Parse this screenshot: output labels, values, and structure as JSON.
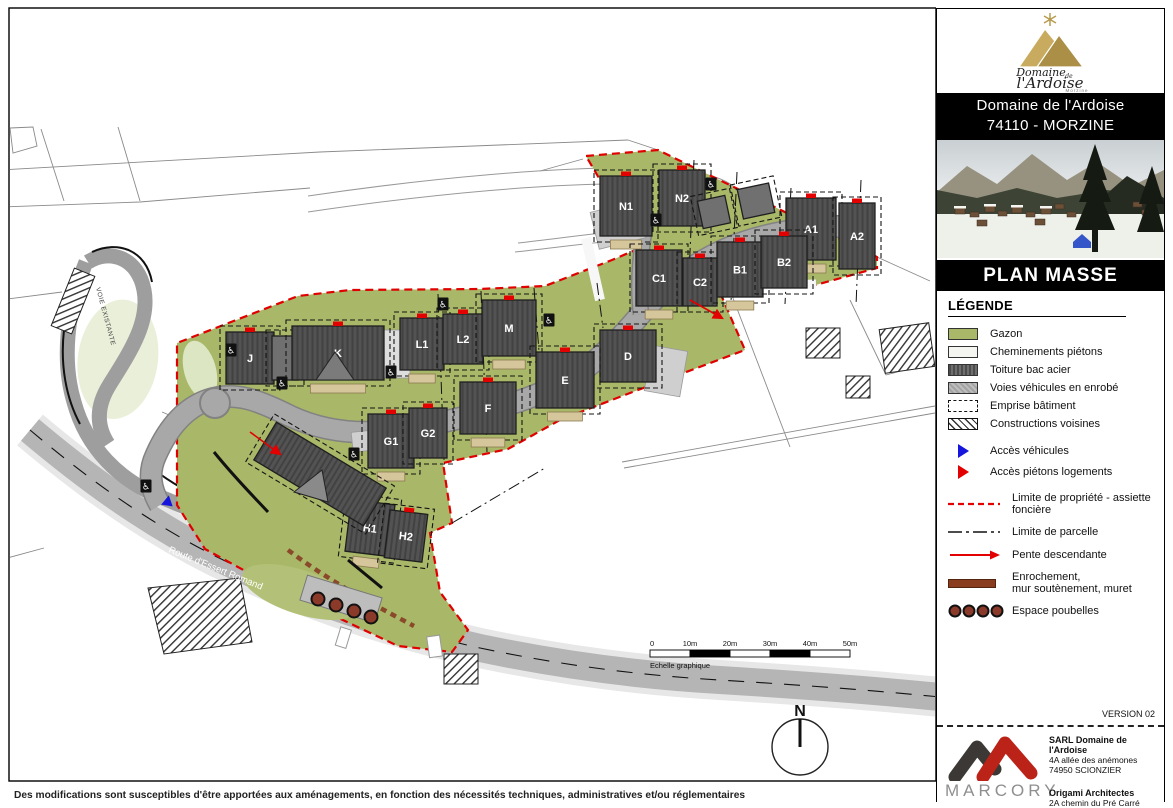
{
  "sidebar": {
    "logo": {
      "name": "Domaine",
      "de": "de",
      "name2": "l'Ardoise",
      "sub": "Morzine"
    },
    "address_banner": {
      "line1": "Domaine de l'Ardoise",
      "line2": "74110 - MORZINE"
    },
    "plan_title": "PLAN MASSE",
    "legend": {
      "title": "LÉGENDE",
      "items": [
        {
          "swatch": "gazon",
          "label": "Gazon"
        },
        {
          "swatch": "chemin",
          "label": "Cheminements piétons"
        },
        {
          "swatch": "toiture",
          "label": "Toiture bac acier"
        },
        {
          "swatch": "enrobe",
          "label": "Voies véhicules en enrobé"
        },
        {
          "swatch": "emprise",
          "label": "Emprise bâtiment"
        },
        {
          "swatch": "voisines",
          "label": "Constructions voisines"
        }
      ],
      "access_items": [
        {
          "swatch": "tri-blue",
          "label": "Accès véhicules"
        },
        {
          "swatch": "tri-red",
          "label": "Accès piétons logements"
        }
      ],
      "line_items": [
        {
          "swatch": "red-dash",
          "label": "Limite de propriété - assiette foncière"
        },
        {
          "swatch": "dash-dot",
          "label": "Limite de parcelle"
        },
        {
          "swatch": "arrow-red",
          "label": "Pente descendante"
        },
        {
          "swatch": "brown-bar",
          "label": "Enrochement,\nmur soutènement, muret"
        },
        {
          "swatch": "bins",
          "label": "Espace poubelles"
        }
      ]
    },
    "version": "VERSION 02",
    "footer": {
      "marcory": "MARCORY",
      "client_name": "SARL Domaine de l'Ardoise",
      "client_addr1": "4A allée des anémones",
      "client_addr2": "74950 SCIONZIER",
      "architect_name": "Origami Architectes",
      "architect_addr": "2A chemin du Pré Carré"
    }
  },
  "map": {
    "colors": {
      "site_green": "#a9b768",
      "road_gray": "#a8a8a8",
      "building": "#4f4f4f",
      "boundary_red": "#e00000"
    },
    "buildings": [
      {
        "label": "N1",
        "x": 600,
        "y": 176,
        "w": 52,
        "h": 60,
        "r": 0,
        "t": 1
      },
      {
        "label": "N2",
        "x": 659,
        "y": 170,
        "w": 46,
        "h": 56,
        "r": 0,
        "t": 0
      },
      {
        "label": "",
        "x": 700,
        "y": 198,
        "w": 28,
        "h": 28,
        "r": -12,
        "t": 0,
        "s": 1
      },
      {
        "label": "",
        "x": 740,
        "y": 186,
        "w": 32,
        "h": 30,
        "r": -12,
        "t": 0,
        "s": 1
      },
      {
        "label": "A1",
        "x": 786,
        "y": 198,
        "w": 50,
        "h": 62,
        "r": 0,
        "t": 1
      },
      {
        "label": "A2",
        "x": 839,
        "y": 203,
        "w": 36,
        "h": 66,
        "r": 0,
        "t": 0
      },
      {
        "label": "C1",
        "x": 636,
        "y": 250,
        "w": 46,
        "h": 56,
        "r": 0,
        "t": 1
      },
      {
        "label": "C2",
        "x": 683,
        "y": 258,
        "w": 34,
        "h": 48,
        "r": 0,
        "t": 0
      },
      {
        "label": "B1",
        "x": 717,
        "y": 242,
        "w": 46,
        "h": 55,
        "r": 0,
        "t": 1
      },
      {
        "label": "B2",
        "x": 761,
        "y": 236,
        "w": 46,
        "h": 52,
        "r": 0,
        "t": 0
      },
      {
        "label": "L1",
        "x": 400,
        "y": 318,
        "w": 44,
        "h": 52,
        "r": 0,
        "t": 1
      },
      {
        "label": "L2",
        "x": 443,
        "y": 314,
        "w": 40,
        "h": 50,
        "r": 0,
        "t": 0
      },
      {
        "label": "M",
        "x": 482,
        "y": 300,
        "w": 54,
        "h": 56,
        "r": 0,
        "t": 1
      },
      {
        "label": "D",
        "x": 600,
        "y": 330,
        "w": 56,
        "h": 52,
        "r": 0,
        "t": 0
      },
      {
        "label": "E",
        "x": 536,
        "y": 352,
        "w": 58,
        "h": 56,
        "r": 0,
        "t": 1
      },
      {
        "label": "F",
        "x": 460,
        "y": 382,
        "w": 56,
        "h": 52,
        "r": 0,
        "t": 1
      },
      {
        "label": "G1",
        "x": 368,
        "y": 414,
        "w": 46,
        "h": 54,
        "r": 0,
        "t": 1
      },
      {
        "label": "G2",
        "x": 409,
        "y": 408,
        "w": 38,
        "h": 50,
        "r": 0,
        "t": 0
      },
      {
        "label": "H1",
        "x": 348,
        "y": 502,
        "w": 44,
        "h": 52,
        "r": 7,
        "t": 1
      },
      {
        "label": "H2",
        "x": 387,
        "y": 512,
        "w": 38,
        "h": 48,
        "r": 7,
        "t": 0
      },
      {
        "label": "J",
        "x": 226,
        "y": 332,
        "w": 48,
        "h": 52,
        "r": 0,
        "t": 0
      },
      {
        "label": "",
        "x": 272,
        "y": 336,
        "w": 26,
        "h": 44,
        "r": 0,
        "t": 0,
        "s": 1
      },
      {
        "label": "K",
        "x": 292,
        "y": 326,
        "w": 92,
        "h": 54,
        "r": 0,
        "t": 1
      },
      {
        "label": "",
        "x": 256,
        "y": 452,
        "w": 128,
        "h": 44,
        "r": 31,
        "t": 0
      }
    ],
    "road_labels": [
      {
        "text": "VOIE EXISTANTE"
      },
      {
        "text": "Route d'Essert Romand"
      }
    ],
    "north_label": "N",
    "scale_bar": {
      "ticks": [
        "0",
        "10m",
        "20m",
        "30m",
        "40m",
        "50m"
      ],
      "caption": "Echelle graphique"
    },
    "disclaimer": "Des modifications sont susceptibles d'être apportées aux aménagements, en fonction des nécessités techniques, administratives et/ou réglementaires"
  }
}
